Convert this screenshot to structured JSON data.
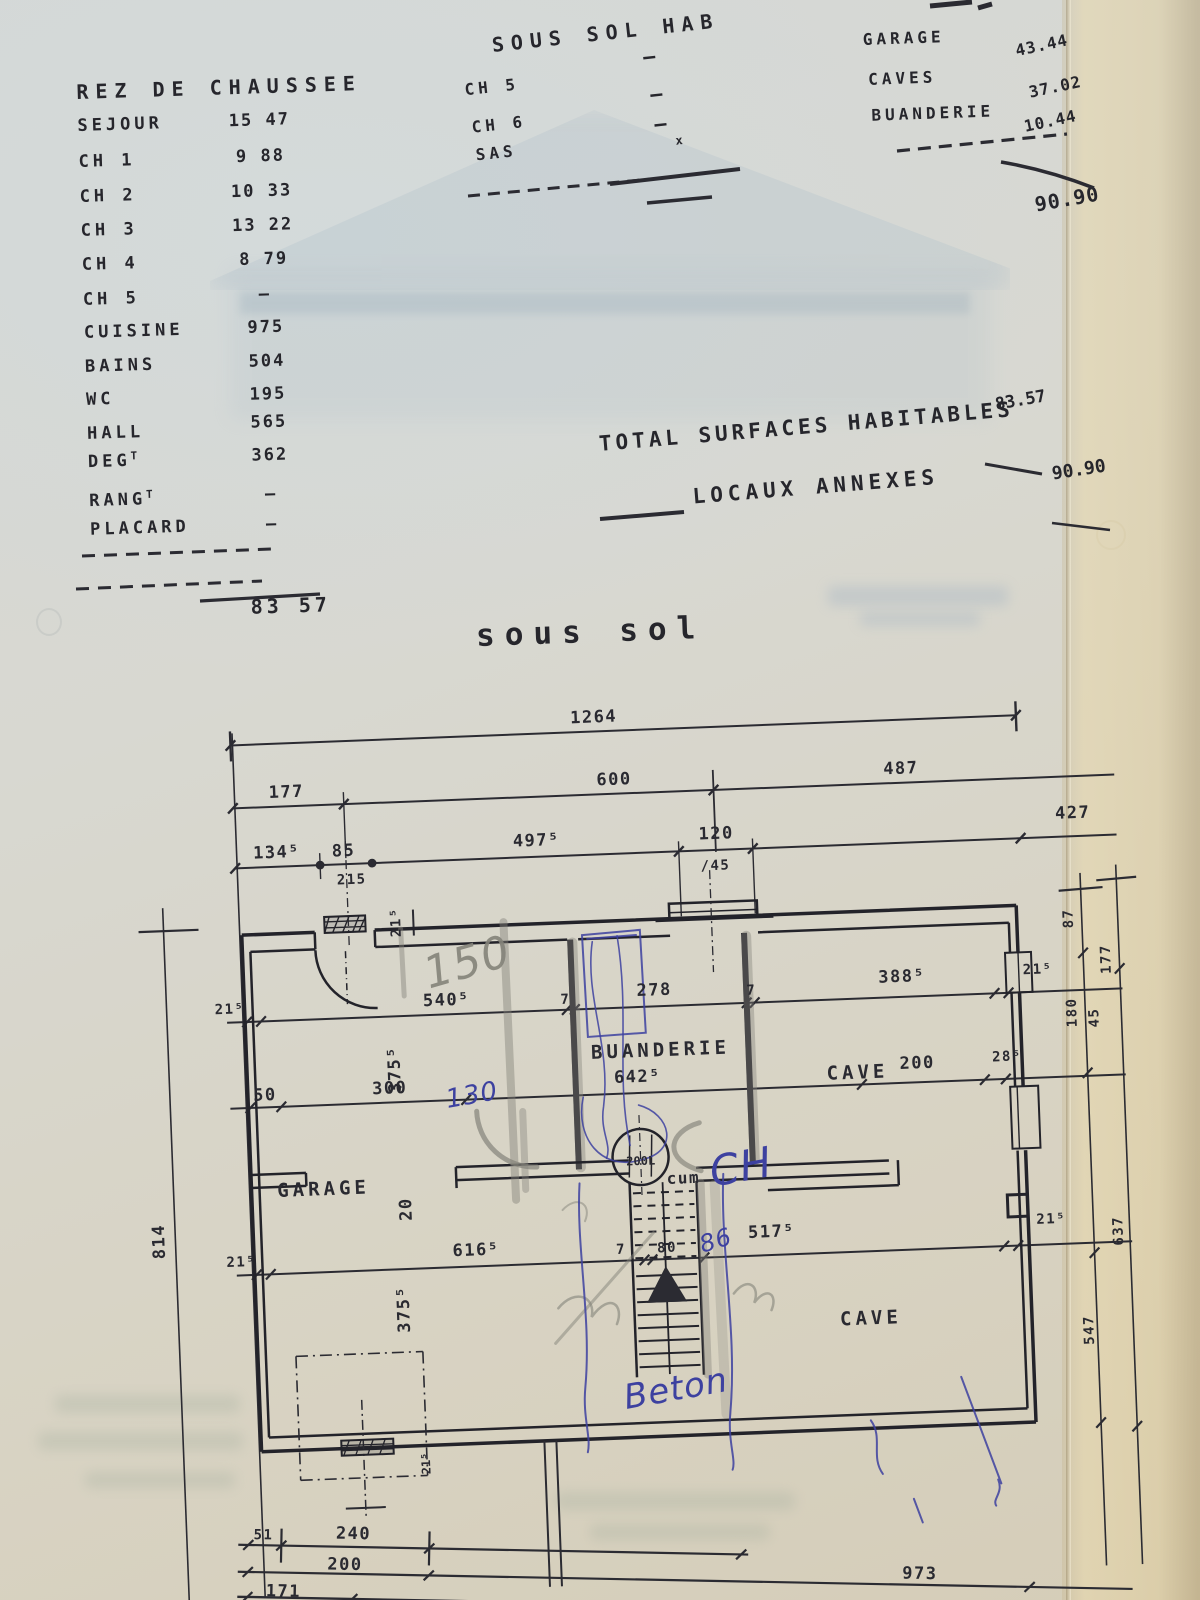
{
  "document": {
    "rez": {
      "title": "REZ DE CHAUSSEE",
      "rows": [
        {
          "label": "SEJOUR",
          "value": "15 47"
        },
        {
          "label": "CH 1",
          "value": "9 88"
        },
        {
          "label": "CH 2",
          "value": "10 33"
        },
        {
          "label": "CH 3",
          "value": "13 22"
        },
        {
          "label": "CH 4",
          "value": "8 79"
        },
        {
          "label": "CH 5",
          "value": "—"
        },
        {
          "label": "CUISINE",
          "value": "975"
        },
        {
          "label": "BAINS",
          "value": "504"
        },
        {
          "label": "WC",
          "value": "195"
        },
        {
          "label": "HALL",
          "value": "565"
        },
        {
          "label": "DEG",
          "sup": "T",
          "value": "362"
        },
        {
          "label": "RANG",
          "sup": "T",
          "value": "—"
        },
        {
          "label": "PLACARD",
          "value": "—"
        }
      ],
      "total": "83 57"
    },
    "hab": {
      "title": "SOUS SOL HAB",
      "rows": [
        {
          "label": "CH 5",
          "value": "—"
        },
        {
          "label": "CH 6",
          "value": "—"
        },
        {
          "label": "SAS",
          "value": "—",
          "mark": "x"
        }
      ]
    },
    "annexes": {
      "rows": [
        {
          "label": "GARAGE",
          "value": "43.44"
        },
        {
          "label": "CAVES",
          "value": "37.02"
        },
        {
          "label": "BUANDERIE",
          "value": "10.44"
        }
      ],
      "total": "90.90"
    },
    "totals": {
      "hab_label": "TOTAL SURFACES HABITABLES",
      "hab_value": "83.57",
      "annex_label": "LOCAUX ANNEXES",
      "annex_value": "90.90"
    }
  },
  "plan": {
    "title": "sous sol",
    "rooms": {
      "buanderie": "BUANDERIE",
      "cave_upper": "CAVE",
      "garage": "GARAGE",
      "cave_lower": "CAVE",
      "cumulus": "cum",
      "tank": "200L"
    },
    "dims": {
      "d1264": "1264",
      "d177t": "177",
      "d600": "600",
      "d487": "487",
      "d134_5": "134⁵",
      "d85": "85",
      "d215": "215",
      "d497_5": "497⁵",
      "d120": "120",
      "d45": "/45",
      "d427": "427",
      "d21_5a": "21⁵",
      "d540_5": "540⁵",
      "d7a": "7",
      "d278": "278",
      "d7b": "7",
      "d388_5": "388⁵",
      "d21_5b": "21⁵",
      "d50": "50",
      "d300": "300",
      "d642_5": "642⁵",
      "d200": "200",
      "d28_5": "28⁵",
      "d21_5c": "21⁵",
      "d616_5": "616⁵",
      "d7c": "7",
      "d80": "80",
      "d517_5": "517⁵",
      "d21_5d": "21⁵",
      "v21_5top": "21⁵",
      "v375_5a": "375⁵",
      "v20": "20",
      "v375_5b": "375⁵",
      "v21_5bot": "21⁵",
      "v814": "814",
      "v87": "87",
      "v177r": "177",
      "v180": "180",
      "v45": "45",
      "v637": "637",
      "v547": "547",
      "b51": "51",
      "b240": "240",
      "b200": "200",
      "b973": "973",
      "b171": "171"
    },
    "hand": {
      "n150": "150",
      "n130": "130",
      "ch": "CH",
      "n86": "86",
      "beton": "Beton"
    }
  }
}
